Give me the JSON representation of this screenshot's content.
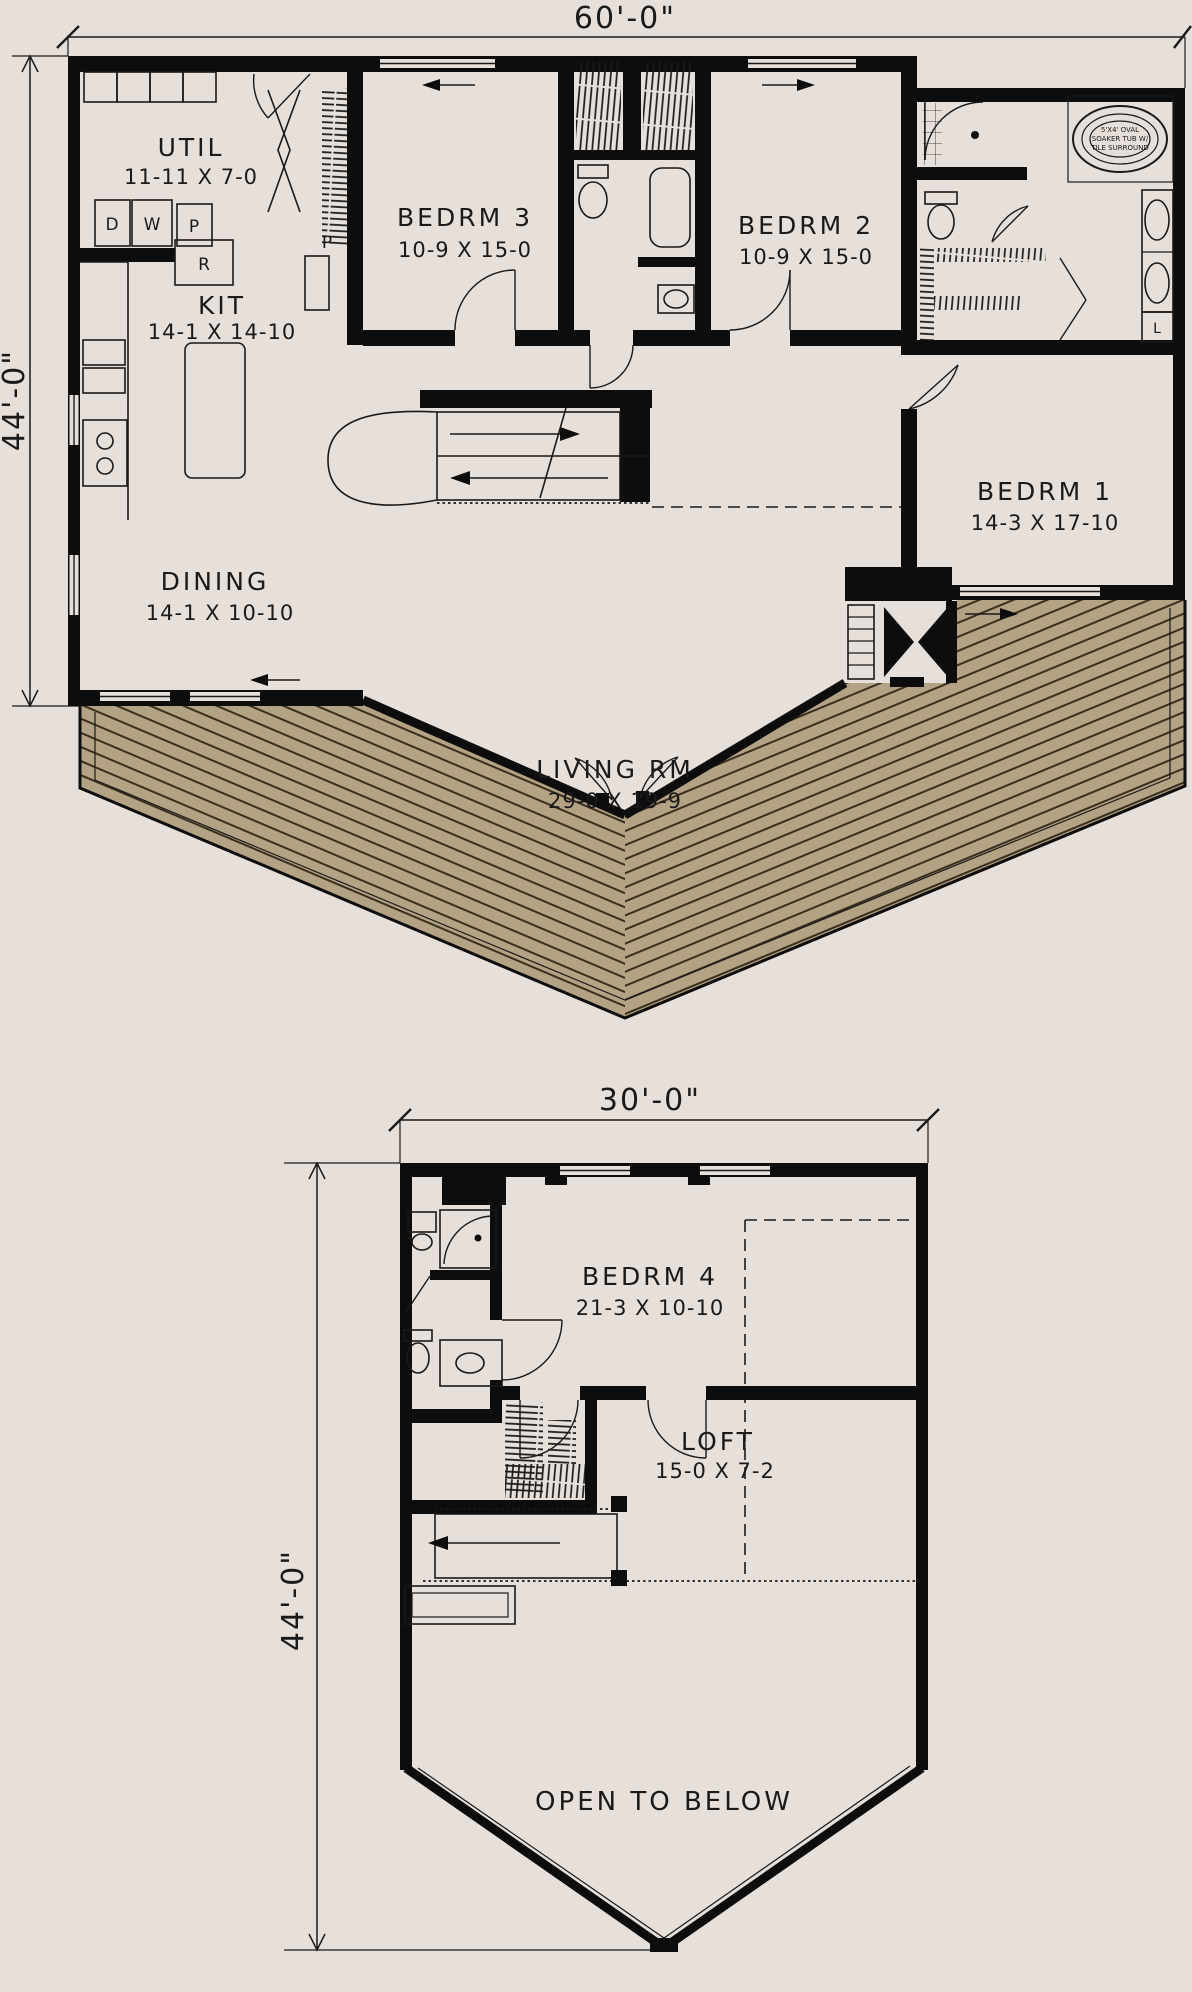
{
  "colors": {
    "background": "#e7dfd9",
    "wall": "#0d0d0d",
    "ink": "#1a1a1a",
    "deck": "#b3a284",
    "deckline": "#3a2f1f"
  },
  "floor1": {
    "dims": {
      "width": "60'-0\"",
      "height": "44'-0\""
    },
    "rooms": {
      "util": {
        "name": "UTIL",
        "size": "11-11 X 7-0"
      },
      "kit": {
        "name": "KIT",
        "size": "14-1 X 14-10"
      },
      "bedrm3": {
        "name": "BEDRM 3",
        "size": "10-9 X 15-0"
      },
      "bedrm2": {
        "name": "BEDRM 2",
        "size": "10-9 X 15-0"
      },
      "bedrm1": {
        "name": "BEDRM 1",
        "size": "14-3 X 17-10"
      },
      "dining": {
        "name": "DINING",
        "size": "14-1 X 10-10"
      },
      "living": {
        "name": "LIVING RM",
        "size": "29-0 X 19-9"
      }
    },
    "labels": {
      "dryer": "D",
      "washer": "W",
      "pantry_util": "P",
      "range": "R",
      "pantry_kit": "P",
      "linen": "L"
    },
    "tub_note": [
      "5'X4' OVAL",
      "SOAKER TUB W/",
      "TILE SURROUND"
    ]
  },
  "floor2": {
    "dims": {
      "width": "30'-0\"",
      "height": "44'-0\""
    },
    "rooms": {
      "bedrm4": {
        "name": "BEDRM 4",
        "size": "21-3 X 10-10"
      },
      "loft": {
        "name": "LOFT",
        "size": "15-0 X 7-2"
      },
      "open_below": {
        "name": "OPEN TO BELOW"
      }
    }
  }
}
